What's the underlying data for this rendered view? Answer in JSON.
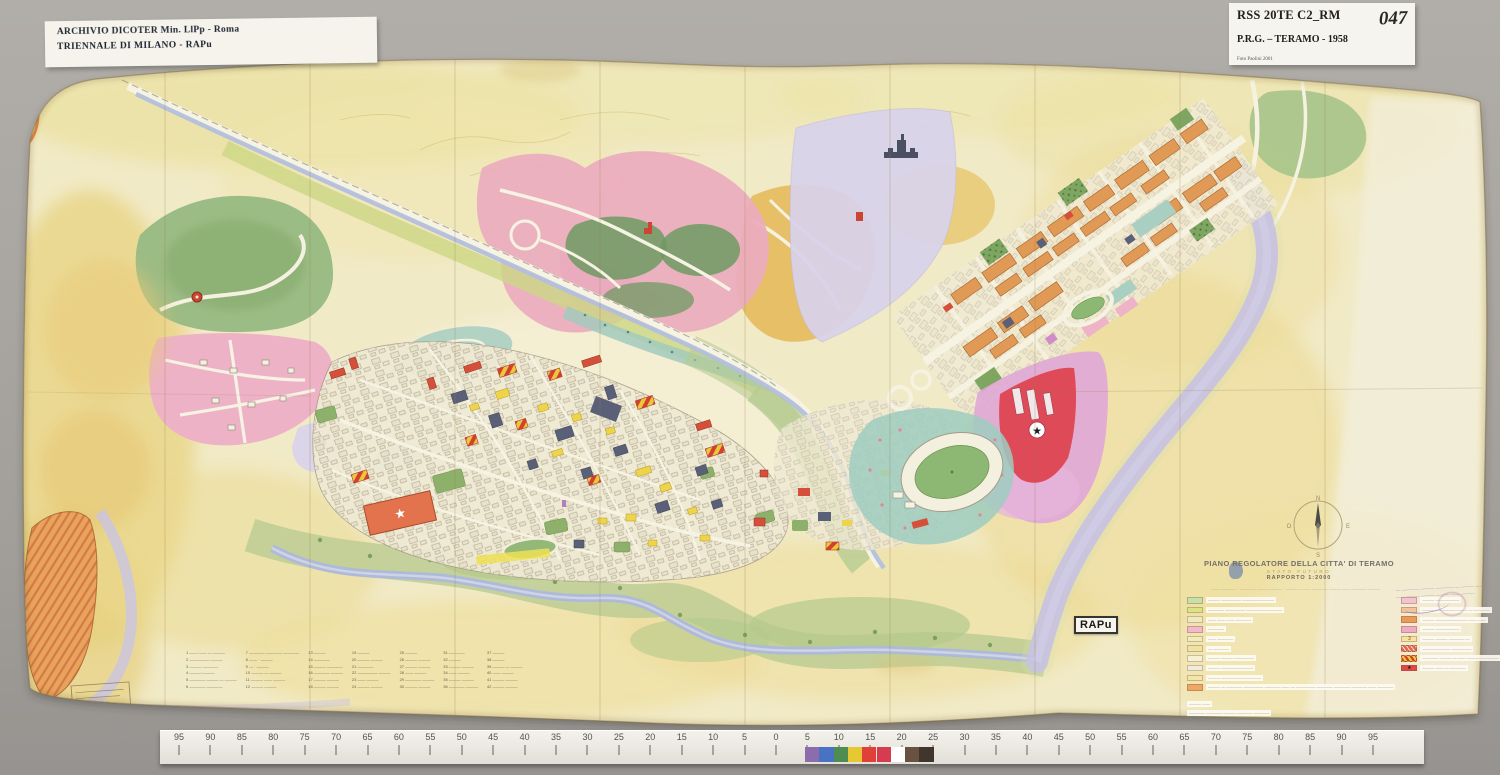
{
  "photo": {
    "backdrop_color": "#a8a5a0",
    "labels": {
      "top_left": {
        "line1": "ARCHIVIO DICOTER Min. LlPp - Roma",
        "line2": "TRIENNALE DI MILANO - RAPu"
      },
      "top_right": {
        "code": "RSS 20TE C2_RM",
        "number": "047",
        "title": "P.R.G. – TERAMO - 1958",
        "credit": "Foto Paolini 2001"
      },
      "rapu_badge": "RAPu"
    }
  },
  "map": {
    "title_block": {
      "title": "PIANO REGOLATORE DELLA CITTA' DI TERAMO",
      "subtitle": "STATO FUTURO",
      "scale": "RAPPORTO 1:2000",
      "byline": "—— ———— · ———— ——— ——— · ——— ——— ———— ——— —— ———— ———"
    },
    "legend": {
      "left_rows": [
        {
          "type": "solid",
          "color": "#c9dfa8",
          "label": "——— ————— ————————"
        },
        {
          "type": "solid",
          "color": "#dce387",
          "label": "———— ————— —————————"
        },
        {
          "type": "solid",
          "color": "#efe9c0",
          "label": "—— —— —— ————"
        },
        {
          "type": "solid",
          "color": "#f2b9ca",
          "label": "————"
        },
        {
          "type": "solid",
          "color": "#f3ecb8",
          "label": "—— ————"
        },
        {
          "type": "solid",
          "color": "#f0e2a4",
          "label": "— ————"
        },
        {
          "type": "solid",
          "color": "#f6f0d2",
          "label": "——— ——— —————"
        },
        {
          "type": "symbols",
          "color": "#f1ecd8",
          "label": "——— ————————"
        },
        {
          "type": "solid",
          "color": "#f3e7a8",
          "label": "——— ——————————"
        },
        {
          "type": "solid",
          "color": "#efa763",
          "label": "——— — ———— ————— ———— —— — ————— ———— ———— ———— —— ————"
        }
      ],
      "right_rows": [
        {
          "type": "solid",
          "color": "#f4c4ce",
          "label": "——— ——————"
        },
        {
          "type": "solid",
          "color": "#f3c3a0",
          "label": "——— ———————— — ————"
        },
        {
          "type": "solid",
          "color": "#ec9a58",
          "label": "——— ———————— —— ——"
        },
        {
          "type": "solid",
          "color": "#efabc0",
          "label": "——— ——————"
        },
        {
          "type": "num",
          "color": "#f3e59c",
          "glyph": "3",
          "label": "——— ——— ———— —"
        },
        {
          "type": "stripes-r",
          "label": "——————— —————"
        },
        {
          "type": "stripes-ry",
          "label": "———— ——— — —— ————————"
        },
        {
          "type": "star",
          "glyph": "★",
          "label": "——— —— — ————"
        }
      ],
      "notes": [
        "——— ——",
        "———— ———— ——— ———— ————"
      ]
    },
    "index_columns": [
      [
        "1 ——·—— — ———",
        "2 ————— ———",
        "3 ——— ————",
        "4 ———·———",
        "5 ———— ——— — ———",
        "6 ———— ————"
      ],
      [
        "7 ———— ———— ————",
        "8 —— · ———",
        "9 — · ———",
        "10 ——— — ———",
        "11 ——— —— ———",
        "12 ——— ———"
      ],
      [
        "13 ———",
        "14 ————",
        "15 ——— ————",
        "16 ———— ———",
        "17 ——— ———",
        "18 ——— ———"
      ],
      [
        "19 ———",
        "20 ——— ———",
        "21 ————",
        "22 ————— ———",
        "23 —— ———",
        "24 ——— ———"
      ],
      [
        "25 ———",
        "26 ——— ———",
        "27 ——— ———",
        "28 —— ———",
        "29 ———— ———",
        "30 ——— ———"
      ],
      [
        "31 ————",
        "32 ———",
        "33 ——— ———",
        "34 —— ———",
        "35 ——— ———",
        "36 ———— ———"
      ],
      [
        "37 ———",
        "38 ———",
        "39 ——— — ———",
        "40 —— ———",
        "41 ——— ———",
        "42 ——— ———"
      ]
    ],
    "compass": {
      "north": "N",
      "south": "S",
      "east": "E",
      "west": "O"
    },
    "handwritten_note": {
      "lines": [
        "— ———— ——— ———— — ——— ———",
        "—— ——— ——— ——— —— ———"
      ]
    },
    "palette": {
      "paper": "#f1eac6",
      "aged_yellow": "#e9d586",
      "hill_green": "#9cbc85",
      "band_green": "#bccd93",
      "river_blue": "#aebad8",
      "lavender_river": "#c7c2e2",
      "lilac_zone": "#d8d2eb",
      "pink_zone": "#eaabbe",
      "orange_zone": "#e19a55",
      "magenta_zone": "#dfa8d6",
      "red_zone": "#de4a58",
      "city_cream": "#efe9d3",
      "slate_building": "#5a6077",
      "yellow_building": "#eed44a",
      "red_building": "#d5503a"
    }
  },
  "ruler": {
    "numbers": [
      95,
      90,
      85,
      80,
      75,
      70,
      65,
      60,
      55,
      50,
      45,
      40,
      35,
      30,
      25,
      20,
      15,
      10,
      5,
      0,
      5,
      10,
      15,
      20,
      25,
      30,
      35,
      40,
      45,
      50,
      55,
      60,
      65,
      70,
      75,
      80,
      85,
      90,
      95
    ],
    "patch_colors": [
      "#8d6cae",
      "#4a72c2",
      "#4e8c52",
      "#e6c832",
      "#e04038",
      "#d63c50",
      "#ffffff",
      "#6a5140",
      "#40362e"
    ]
  }
}
